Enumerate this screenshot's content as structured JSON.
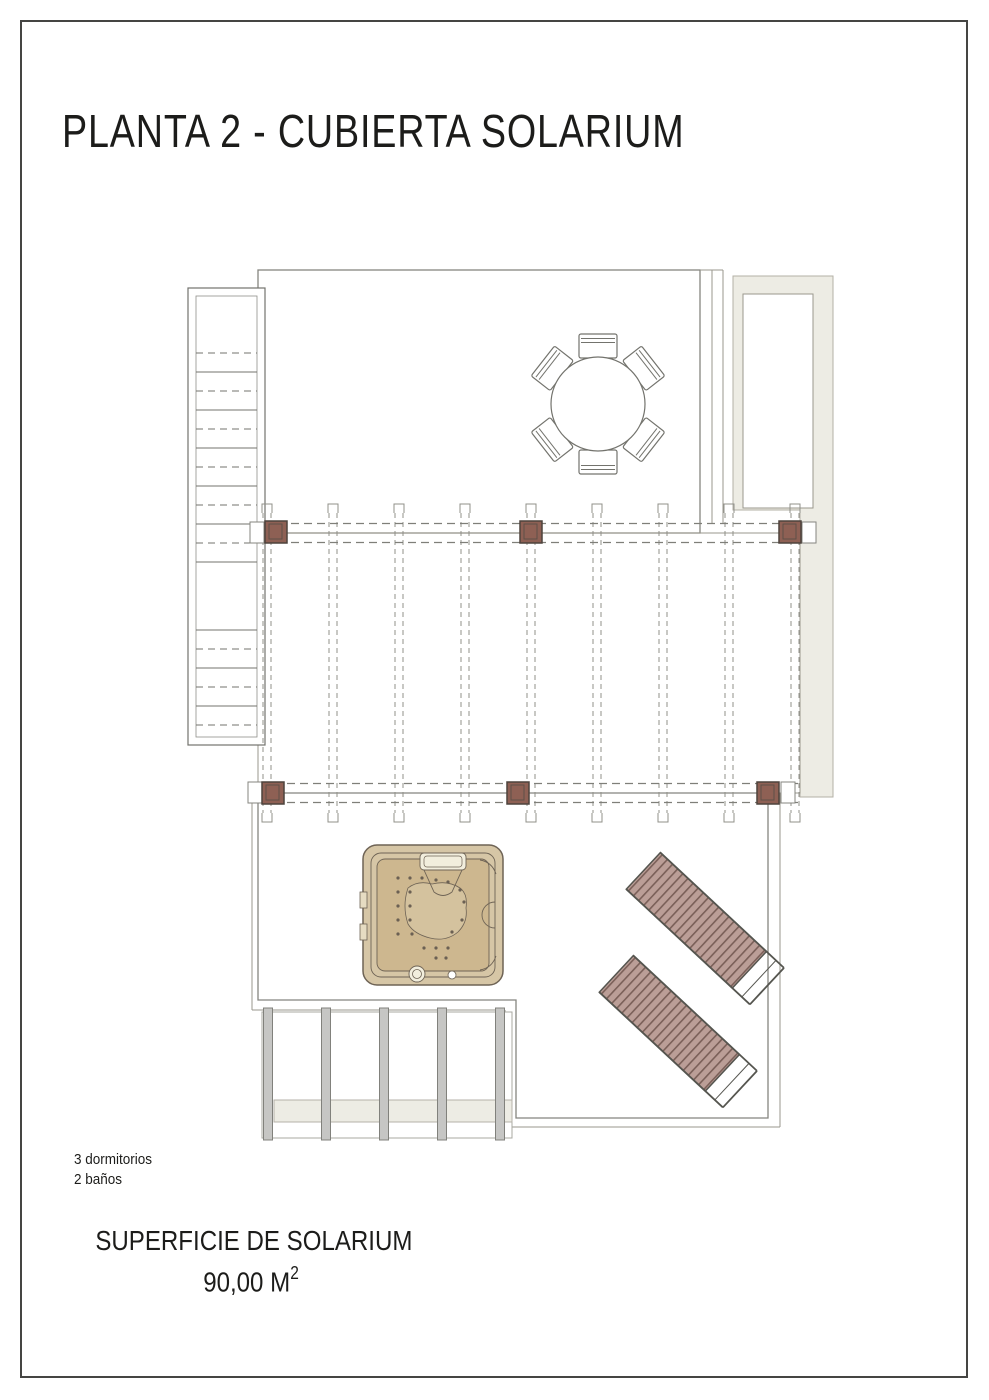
{
  "page_title": "PLANTA 2 - CUBIERTA SOLARIUM",
  "details": {
    "bedrooms": "3 dormitorios",
    "bathrooms": "2 baños"
  },
  "surface": {
    "label": "SUPERFICIE DE SOLARIUM",
    "value": "90,00 M",
    "sup": "2"
  },
  "plan": {
    "type": "architectural-floor-plan",
    "floor": "Planta 2",
    "area": "Cubierta Solarium",
    "furniture": [
      {
        "name": "staircase",
        "description": "exterior stair with mid landing, alternating solid/dashed treads"
      },
      {
        "name": "dining-set",
        "description": "round table with 6 chairs"
      },
      {
        "name": "pergola",
        "posts": 6,
        "rafters": 9,
        "beams": 2
      },
      {
        "name": "jacuzzi",
        "description": "square hot tub with pillow, jets and controls"
      },
      {
        "name": "sun-lounger",
        "count": 2,
        "rotation_deg": 43
      },
      {
        "name": "lower-floor-glazing",
        "mullions": 5
      }
    ],
    "colors": {
      "grid_line": "#cfc6b6",
      "outline": "#85857f",
      "post_brown": "#8e6054",
      "post_border": "#4d423c",
      "lounger_fill": "#bb9e97",
      "lounger_stripe": "#7a5f58",
      "spa_shell": "#d6c6a6",
      "spa_basin": "#cdb78f",
      "spa_floor": "#d4c29e",
      "building_mass": "#edece4",
      "mullion_gray": "#c6c6c4"
    }
  }
}
